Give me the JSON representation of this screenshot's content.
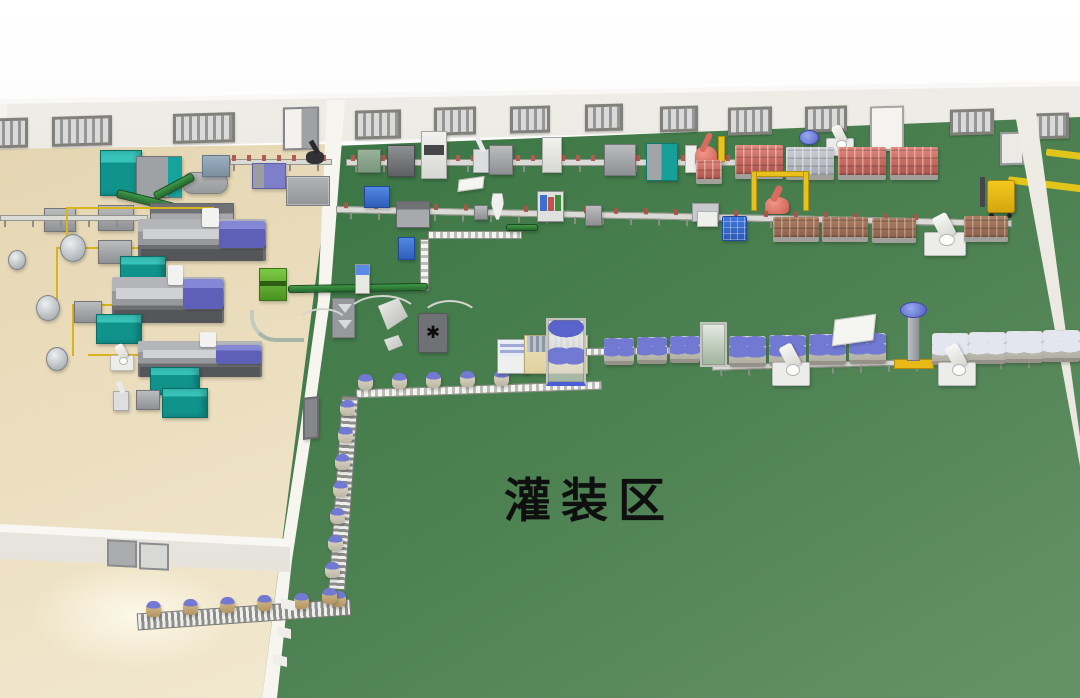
{
  "labels": {
    "filling_area": "灌装区"
  },
  "palette": {
    "yellow": "#e2c51a",
    "drum_cap": "#7279d2",
    "floor_green": "#4d8152",
    "floor_beige": "#ecdfc0",
    "wall": "#efede8",
    "teal_machine": "#10938b",
    "purple_machine": "#6a6cc2",
    "red_cans": "#c3665c",
    "robot_red": "#cc5d50",
    "forklift_yellow": "#f3c81e",
    "conveyor_green": "#2f7d36"
  },
  "windows": [
    {
      "x": -6,
      "y": 118,
      "w": 34,
      "h": 30
    },
    {
      "x": 52,
      "y": 116,
      "w": 60,
      "h": 30
    },
    {
      "x": 173,
      "y": 113,
      "w": 62,
      "h": 30
    },
    {
      "x": 355,
      "y": 110,
      "w": 46,
      "h": 29
    },
    {
      "x": 434,
      "y": 107,
      "w": 42,
      "h": 28
    },
    {
      "x": 510,
      "y": 106,
      "w": 40,
      "h": 27
    },
    {
      "x": 585,
      "y": 104,
      "w": 38,
      "h": 27
    },
    {
      "x": 660,
      "y": 106,
      "w": 38,
      "h": 26
    },
    {
      "x": 728,
      "y": 107,
      "w": 44,
      "h": 28
    },
    {
      "x": 805,
      "y": 106,
      "w": 42,
      "h": 26
    },
    {
      "x": 950,
      "y": 109,
      "w": 44,
      "h": 26
    },
    {
      "x": 1031,
      "y": 113,
      "w": 38,
      "h": 26
    }
  ],
  "doors": [
    {
      "x": 283,
      "y": 107,
      "w": 36,
      "h": 43,
      "v": "sliding"
    },
    {
      "x": 870,
      "y": 106,
      "w": 34,
      "h": 45,
      "v": "white"
    },
    {
      "x": 1000,
      "y": 132,
      "w": 24,
      "h": 33,
      "v": "panel"
    }
  ],
  "objects": [
    {
      "t": "teal-cabinet",
      "x": 100,
      "y": 150,
      "w": 42,
      "h": 46
    },
    {
      "t": "gray-machine",
      "x": 136,
      "y": 156,
      "w": 46,
      "h": 42,
      "v": "teal-trim"
    },
    {
      "t": "dryer-gray",
      "x": 182,
      "y": 172,
      "w": 46,
      "h": 22
    },
    {
      "t": "steel-machine",
      "x": 202,
      "y": 155,
      "w": 28,
      "h": 22
    },
    {
      "t": "conveyor-belt",
      "x": 230,
      "y": 159,
      "w": 102,
      "h": 6,
      "items": "red"
    },
    {
      "t": "black-robot",
      "x": 302,
      "y": 140,
      "w": 26,
      "h": 24
    },
    {
      "t": "purple-machine-sm",
      "x": 252,
      "y": 163,
      "w": 34,
      "h": 26
    },
    {
      "t": "gray-cluster",
      "x": 286,
      "y": 176,
      "w": 44,
      "h": 30
    },
    {
      "t": "green-conveyor",
      "x": 116,
      "y": 196,
      "w": 60,
      "h": 9,
      "r": 14
    },
    {
      "t": "green-conveyor",
      "x": 152,
      "y": 182,
      "w": 44,
      "h": 9,
      "r": -28
    },
    {
      "t": "conveyor-belt",
      "x": 346,
      "y": 159,
      "w": 390,
      "h": 7,
      "items": "red"
    },
    {
      "t": "green-machine-sm",
      "x": 357,
      "y": 149,
      "w": 24,
      "h": 24
    },
    {
      "t": "gray-dark-machine",
      "x": 387,
      "y": 145,
      "w": 28,
      "h": 32
    },
    {
      "t": "white-cabinet",
      "x": 421,
      "y": 131,
      "w": 26,
      "h": 48,
      "v": "stripe"
    },
    {
      "t": "silver-robot-sm",
      "x": 473,
      "y": 149,
      "w": 16,
      "h": 24
    },
    {
      "t": "gray-machine",
      "x": 489,
      "y": 145,
      "w": 24,
      "h": 30
    },
    {
      "t": "white-cabinet",
      "x": 542,
      "y": 137,
      "w": 20,
      "h": 36
    },
    {
      "t": "gray-machine",
      "x": 604,
      "y": 144,
      "w": 32,
      "h": 32
    },
    {
      "t": "teal-gray-machine",
      "x": 646,
      "y": 143,
      "w": 32,
      "h": 38
    },
    {
      "t": "white-panel",
      "x": 685,
      "y": 145,
      "w": 12,
      "h": 28
    },
    {
      "t": "red-robot",
      "x": 692,
      "y": 133,
      "w": 28,
      "h": 34
    },
    {
      "t": "yellow-post",
      "x": 718,
      "y": 136,
      "w": 7,
      "h": 26
    },
    {
      "t": "pallet-cans",
      "x": 696,
      "y": 160,
      "w": 26,
      "h": 24,
      "v": "red"
    },
    {
      "t": "pallet-cans",
      "x": 735,
      "y": 145,
      "w": 48,
      "h": 34,
      "v": "red"
    },
    {
      "t": "blue-drum-top",
      "x": 799,
      "y": 130,
      "w": 20,
      "h": 15
    },
    {
      "t": "white-robot-arm",
      "x": 826,
      "y": 138,
      "w": 28,
      "h": 18
    },
    {
      "t": "pallet-cans",
      "x": 786,
      "y": 147,
      "w": 48,
      "h": 33,
      "v": "silver"
    },
    {
      "t": "pallet-cans",
      "x": 838,
      "y": 147,
      "w": 48,
      "h": 33,
      "v": "red"
    },
    {
      "t": "pallet-cans",
      "x": 890,
      "y": 147,
      "w": 48,
      "h": 33,
      "v": "red"
    },
    {
      "t": "forklift",
      "x": 976,
      "y": 176,
      "w": 44,
      "h": 42
    },
    {
      "t": "gantry-yellow",
      "x": 751,
      "y": 171,
      "w": 58,
      "h": 40
    },
    {
      "t": "red-robot",
      "x": 762,
      "y": 186,
      "w": 30,
      "h": 28,
      "v": "big"
    },
    {
      "t": "conveyor-belt",
      "x": 336,
      "y": 213,
      "w": 676,
      "h": 7,
      "r": 1.2,
      "items": "red-sparse"
    },
    {
      "t": "blue-machine",
      "x": 364,
      "y": 186,
      "w": 26,
      "h": 22
    },
    {
      "t": "gray-long-machine",
      "x": 396,
      "y": 201,
      "w": 34,
      "h": 27
    },
    {
      "t": "white-table",
      "x": 458,
      "y": 178,
      "w": 26,
      "h": 12
    },
    {
      "t": "gray-machine",
      "x": 474,
      "y": 205,
      "w": 14,
      "h": 15
    },
    {
      "t": "white-funnel",
      "x": 491,
      "y": 193,
      "w": 13,
      "h": 27
    },
    {
      "t": "packer-machine",
      "x": 537,
      "y": 191,
      "w": 27,
      "h": 31
    },
    {
      "t": "gray-machine",
      "x": 585,
      "y": 205,
      "w": 17,
      "h": 21
    },
    {
      "t": "silver-machine",
      "x": 692,
      "y": 203,
      "w": 27,
      "h": 19
    },
    {
      "t": "white-machine",
      "x": 697,
      "y": 211,
      "w": 21,
      "h": 16
    },
    {
      "t": "blue-crates",
      "x": 722,
      "y": 216,
      "w": 25,
      "h": 25
    },
    {
      "t": "pallet-cans",
      "x": 773,
      "y": 217,
      "w": 46,
      "h": 25,
      "v": "brown"
    },
    {
      "t": "pallet-cans",
      "x": 822,
      "y": 217,
      "w": 46,
      "h": 25,
      "v": "brown"
    },
    {
      "t": "pallet-cans",
      "x": 872,
      "y": 218,
      "w": 44,
      "h": 25,
      "v": "brown"
    },
    {
      "t": "white-robot-arm",
      "x": 924,
      "y": 232,
      "w": 42,
      "h": 24,
      "v": "big"
    },
    {
      "t": "pallet-cans",
      "x": 964,
      "y": 216,
      "w": 44,
      "h": 26,
      "v": "brown"
    },
    {
      "t": "slat-conveyor",
      "x": 428,
      "y": 231,
      "w": 94,
      "h": 8
    },
    {
      "t": "green-conveyor",
      "x": 506,
      "y": 224,
      "w": 32,
      "h": 7
    },
    {
      "t": "slat-conveyor",
      "x": 420,
      "y": 239,
      "w": 9,
      "h": 52,
      "v": "vert"
    },
    {
      "t": "blue-machine",
      "x": 398,
      "y": 237,
      "w": 17,
      "h": 23
    },
    {
      "t": "green-conveyor",
      "x": 288,
      "y": 284,
      "w": 140,
      "h": 8,
      "r": -1
    },
    {
      "t": "blue-tower",
      "x": 355,
      "y": 264,
      "w": 15,
      "h": 30
    },
    {
      "t": "gray-arrow-panel",
      "x": 332,
      "y": 298,
      "w": 23,
      "h": 40
    },
    {
      "t": "wire-arc",
      "x": 345,
      "y": 295,
      "w": 75,
      "h": 45
    },
    {
      "t": "wire-arc",
      "x": 295,
      "y": 308,
      "w": 55,
      "h": 38
    },
    {
      "t": "wire-arc",
      "x": 420,
      "y": 300,
      "w": 60,
      "h": 40
    },
    {
      "t": "silver-chute",
      "x": 378,
      "y": 298,
      "w": 30,
      "h": 32
    },
    {
      "t": "silver-tray",
      "x": 384,
      "y": 335,
      "w": 19,
      "h": 16
    },
    {
      "t": "dark-platform",
      "x": 418,
      "y": 313,
      "w": 30,
      "h": 40
    },
    {
      "t": "conveyor-belt",
      "x": 712,
      "y": 360,
      "w": 352,
      "h": 6,
      "r": -1.5
    },
    {
      "t": "slat-conveyor",
      "x": 356,
      "y": 385,
      "w": 246,
      "h": 9,
      "r": -2
    },
    {
      "t": "drum-single",
      "x": 358,
      "y": 374,
      "n": 5,
      "dx": 34,
      "dy": -1
    },
    {
      "t": "labeler-machine",
      "x": 497,
      "y": 339,
      "w": 31,
      "h": 35
    },
    {
      "t": "cream-machine",
      "x": 524,
      "y": 335,
      "w": 64,
      "h": 39
    },
    {
      "t": "frame-cabinet",
      "x": 546,
      "y": 318,
      "w": 40,
      "h": 68,
      "v": "drums"
    },
    {
      "t": "slat-conveyor",
      "x": 586,
      "y": 347,
      "w": 116,
      "h": 8,
      "r": -1
    },
    {
      "t": "drum-pack",
      "x": 604,
      "y": 338,
      "w": 30,
      "h": 27,
      "n": 3,
      "dx": 33,
      "dy": -1
    },
    {
      "t": "frame-cabinet",
      "x": 700,
      "y": 322,
      "w": 27,
      "h": 45
    },
    {
      "t": "drum-pack",
      "x": 729,
      "y": 336,
      "w": 37,
      "h": 31,
      "n": 4,
      "dx": 40,
      "dy": -1
    },
    {
      "t": "white-table",
      "x": 833,
      "y": 317,
      "w": 42,
      "h": 26
    },
    {
      "t": "column-machine",
      "x": 894,
      "y": 305,
      "w": 40,
      "h": 64
    },
    {
      "t": "drum-pack",
      "x": 932,
      "y": 333,
      "w": 37,
      "h": 32,
      "n": 4,
      "dx": 37,
      "dy": -1,
      "v": "white"
    },
    {
      "t": "white-robot-arm",
      "x": 772,
      "y": 362,
      "w": 38,
      "h": 24,
      "v": "big"
    },
    {
      "t": "white-robot-arm",
      "x": 938,
      "y": 362,
      "w": 38,
      "h": 24,
      "v": "big"
    },
    {
      "t": "roller-conveyor",
      "x": 335,
      "y": 396,
      "w": 17,
      "h": 194,
      "v": "vert",
      "r": 4
    },
    {
      "t": "drum-single",
      "x": 340,
      "y": 400,
      "n": 7,
      "dx": -2.5,
      "dy": 27
    },
    {
      "t": "roller-conveyor",
      "x": 137,
      "y": 606,
      "w": 214,
      "h": 17,
      "r": -4
    },
    {
      "t": "drum-single",
      "x": 146,
      "y": 601,
      "n": 6,
      "dx": 37,
      "dy": -2,
      "v": "gold"
    },
    {
      "t": "drum-single",
      "x": 322,
      "y": 588,
      "v": "gold"
    },
    {
      "t": "gray-machine",
      "x": 44,
      "y": 208,
      "w": 32,
      "h": 24
    },
    {
      "t": "gray-machine",
      "x": 98,
      "y": 205,
      "w": 36,
      "h": 26
    },
    {
      "t": "gray-long-machine",
      "x": 150,
      "y": 203,
      "w": 84,
      "h": 33
    },
    {
      "t": "conveyor-belt",
      "x": 0,
      "y": 215,
      "w": 148,
      "h": 6
    },
    {
      "t": "pipe-yellow",
      "x": 66,
      "y": 207,
      "w": 148,
      "h": 2
    },
    {
      "t": "pipe-yellow",
      "x": 66,
      "y": 207,
      "w": 2,
      "h": 42
    },
    {
      "t": "pipe-yellow",
      "x": 56,
      "y": 247,
      "w": 150,
      "h": 2
    },
    {
      "t": "pipe-yellow",
      "x": 56,
      "y": 247,
      "w": 2,
      "h": 58
    },
    {
      "t": "pipe-yellow",
      "x": 72,
      "y": 304,
      "w": 124,
      "h": 2
    },
    {
      "t": "pipe-yellow",
      "x": 72,
      "y": 304,
      "w": 2,
      "h": 52
    },
    {
      "t": "pipe-yellow",
      "x": 88,
      "y": 354,
      "w": 112,
      "h": 2
    },
    {
      "t": "silver-tank",
      "x": 8,
      "y": 250,
      "w": 18,
      "h": 20
    },
    {
      "t": "silver-tank",
      "x": 60,
      "y": 234,
      "w": 26,
      "h": 28
    },
    {
      "t": "gray-machine",
      "x": 98,
      "y": 240,
      "w": 34,
      "h": 24
    },
    {
      "t": "imm",
      "x": 138,
      "y": 219,
      "w": 128,
      "h": 42
    },
    {
      "t": "teal-cabinet",
      "x": 120,
      "y": 256,
      "w": 46,
      "h": 31
    },
    {
      "t": "silver-tank",
      "x": 36,
      "y": 295,
      "w": 24,
      "h": 26
    },
    {
      "t": "gray-machine",
      "x": 74,
      "y": 301,
      "w": 28,
      "h": 22
    },
    {
      "t": "imm",
      "x": 112,
      "y": 277,
      "w": 112,
      "h": 46
    },
    {
      "t": "teal-cabinet",
      "x": 96,
      "y": 314,
      "w": 46,
      "h": 30
    },
    {
      "t": "lime-machine",
      "x": 259,
      "y": 268,
      "w": 28,
      "h": 33
    },
    {
      "t": "tube-curve",
      "x": 250,
      "y": 310,
      "w": 54,
      "h": 32
    },
    {
      "t": "silver-tank",
      "x": 46,
      "y": 347,
      "w": 22,
      "h": 24
    },
    {
      "t": "white-robot-arm",
      "x": 110,
      "y": 355,
      "w": 24,
      "h": 16
    },
    {
      "t": "imm",
      "x": 138,
      "y": 341,
      "w": 124,
      "h": 36,
      "v": "small"
    },
    {
      "t": "teal-cabinet",
      "x": 150,
      "y": 367,
      "w": 50,
      "h": 28
    },
    {
      "t": "silver-robot-sm",
      "x": 113,
      "y": 391,
      "w": 16,
      "h": 20
    },
    {
      "t": "gray-machine",
      "x": 136,
      "y": 390,
      "w": 24,
      "h": 20
    },
    {
      "t": "teal-cabinet",
      "x": 162,
      "y": 388,
      "w": 46,
      "h": 30
    },
    {
      "t": "gray-door",
      "x": 303,
      "y": 397,
      "w": 16,
      "h": 42
    },
    {
      "t": "wall-fin",
      "x": 281,
      "y": 598,
      "w": 14,
      "h": 13
    },
    {
      "t": "wall-fin",
      "x": 277,
      "y": 626,
      "w": 14,
      "h": 13
    },
    {
      "t": "wall-fin",
      "x": 273,
      "y": 654,
      "w": 14,
      "h": 13
    }
  ]
}
